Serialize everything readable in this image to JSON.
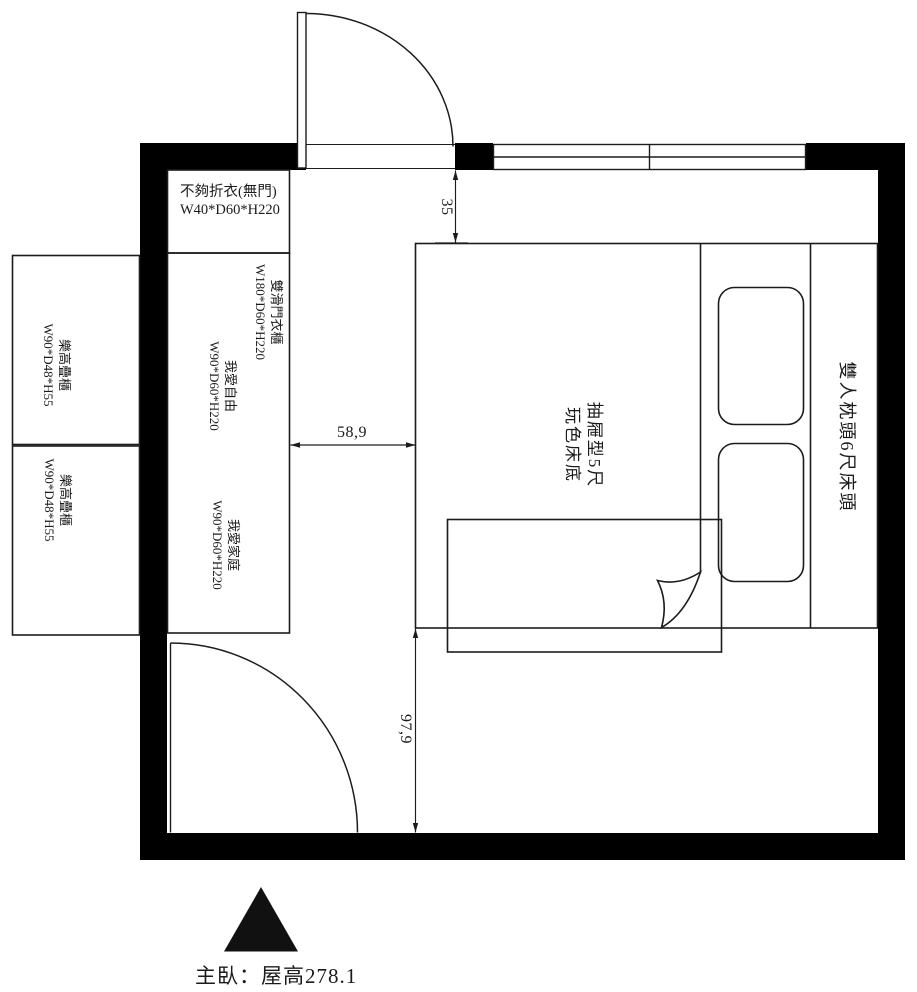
{
  "title": "主臥：屋高278.1",
  "room": {
    "label_no_door_shelf": {
      "name": "不夠折衣(無門)",
      "size": "W40*D60*H220"
    },
    "label_sliding_wardrobe": {
      "name": "雙滑門衣櫃",
      "size": "W180*D60*H220"
    },
    "label_freedom": {
      "name": "我愛自由",
      "size": "W90*D60*H220"
    },
    "label_family": {
      "name": "我愛家庭",
      "size": "W90*D60*H220"
    },
    "label_lego_top": {
      "name": "樂高疊櫃",
      "size": "W90*D48*H55"
    },
    "label_lego_bottom": {
      "name": "樂高疊櫃",
      "size": "W90*D48*H55"
    },
    "bed": {
      "base_line1": "抽屜型5尺",
      "base_line2": "玩色床底",
      "headboard": "雙人枕頭6尺床頭"
    },
    "dimensions": {
      "wall_to_bed_top": "35",
      "wardrobe_to_bed": "58,9",
      "bed_to_bottom_wall": "97,9"
    }
  },
  "colors": {
    "wall": "#000000",
    "line": "#1c1c1c",
    "background": "#ffffff"
  }
}
